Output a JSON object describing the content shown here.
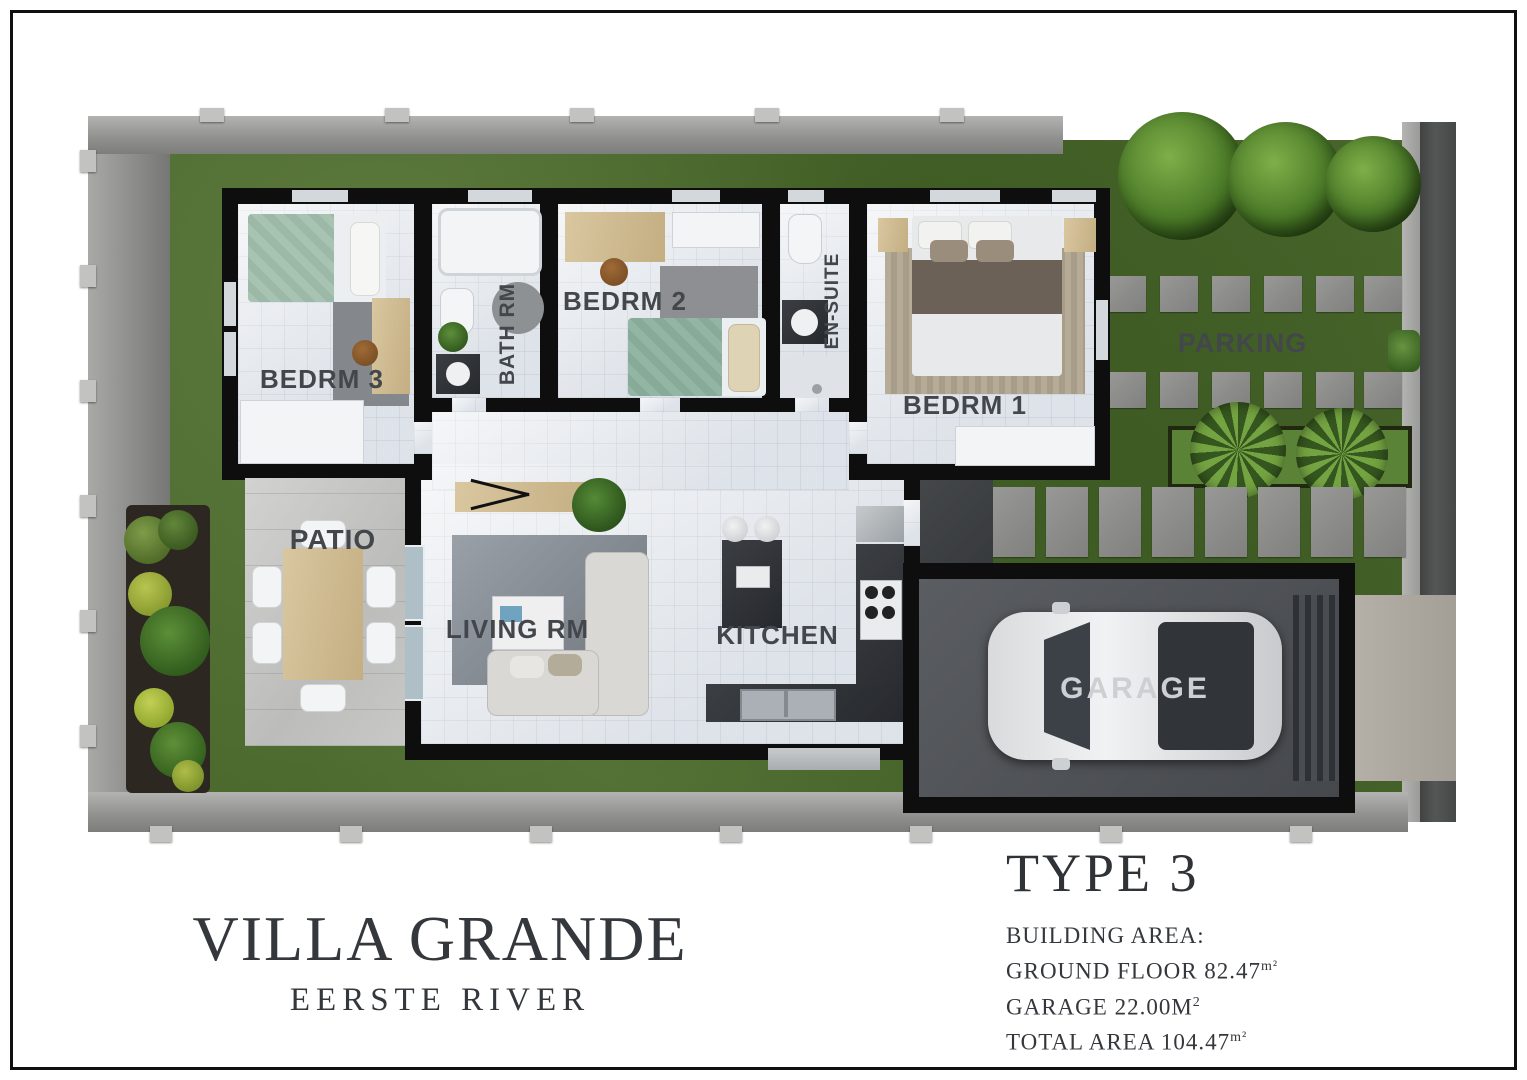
{
  "site": {
    "parking_label": "PARKING"
  },
  "rooms": [
    {
      "id": "bedrm3",
      "label": "BEDRM 3"
    },
    {
      "id": "bathrm",
      "label": "BATH RM"
    },
    {
      "id": "bedrm2",
      "label": "BEDRM 2"
    },
    {
      "id": "ensuite",
      "label": "EN-SUITE"
    },
    {
      "id": "bedrm1",
      "label": "BEDRM 1"
    },
    {
      "id": "patio",
      "label": "PATIO"
    },
    {
      "id": "living",
      "label": "LIVING RM"
    },
    {
      "id": "kitchen",
      "label": "KITCHEN"
    },
    {
      "id": "garage",
      "label": "GARAGE"
    }
  ],
  "title": {
    "name": "VILLA GRANDE",
    "location": "EERSTE RIVER"
  },
  "spec": {
    "type": "TYPE 3",
    "heading": "BUILDING AREA:",
    "lines": [
      {
        "text": "GROUND FLOOR 82.47",
        "sup": "m²"
      },
      {
        "text": "GARAGE 22.00M",
        "sup": "2"
      },
      {
        "text": "TOTAL AREA 104.47",
        "sup": "m²"
      }
    ]
  },
  "colors": {
    "wall": "#0e0e0e",
    "grass": "#4c6a2e",
    "label": "#43474b",
    "title_text": "#34373b",
    "road": "#4d4e4e",
    "accent_green": "#4a7a27"
  }
}
